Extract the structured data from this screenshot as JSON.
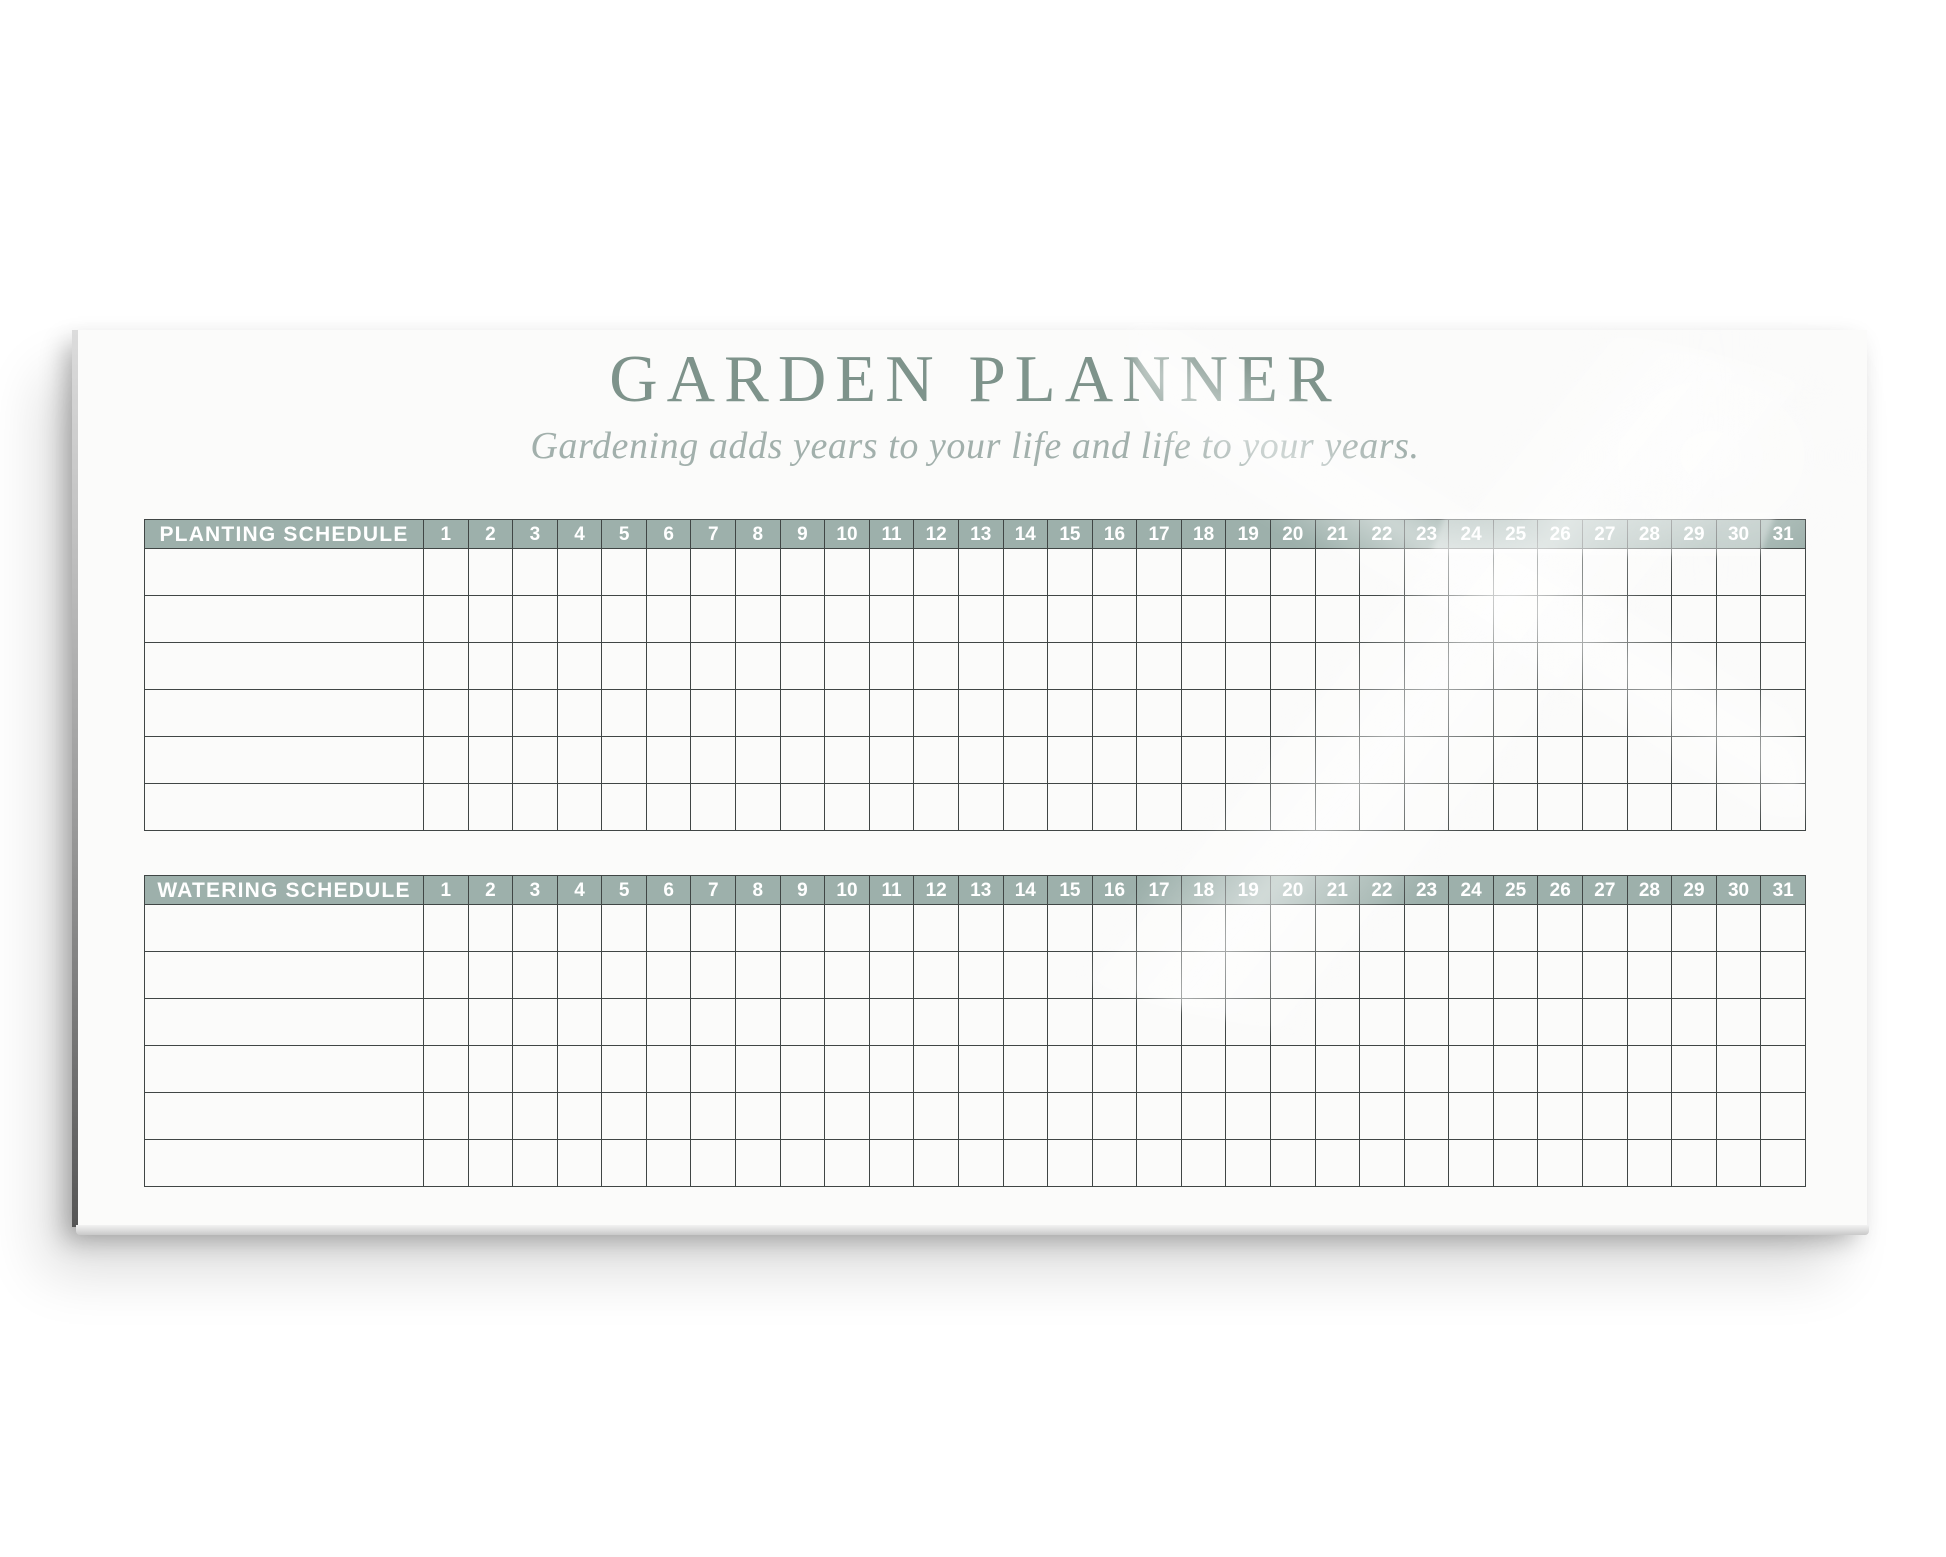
{
  "board": {
    "title": "GARDEN PLANNER",
    "subtitle": "Gardening adds years to your life and life to your years."
  },
  "colors": {
    "header_band": "#9db0ab",
    "title_text": "#7e938b",
    "subtitle_text": "#a2b0ac",
    "grid_line": "#404645",
    "header_text": "#ffffff",
    "board_face": "#fbfbfa"
  },
  "tables": [
    {
      "name": "planting-schedule-table",
      "label": "PLANTING SCHEDULE",
      "days": [
        "1",
        "2",
        "3",
        "4",
        "5",
        "6",
        "7",
        "8",
        "9",
        "10",
        "11",
        "12",
        "13",
        "14",
        "15",
        "16",
        "17",
        "18",
        "19",
        "20",
        "21",
        "22",
        "23",
        "24",
        "25",
        "26",
        "27",
        "28",
        "29",
        "30",
        "31"
      ],
      "row_count": 6
    },
    {
      "name": "watering-schedule-table",
      "label": "WATERING SCHEDULE",
      "days": [
        "1",
        "2",
        "3",
        "4",
        "5",
        "6",
        "7",
        "8",
        "9",
        "10",
        "11",
        "12",
        "13",
        "14",
        "15",
        "16",
        "17",
        "18",
        "19",
        "20",
        "21",
        "22",
        "23",
        "24",
        "25",
        "26",
        "27",
        "28",
        "29",
        "30",
        "31"
      ],
      "row_count": 6
    }
  ]
}
